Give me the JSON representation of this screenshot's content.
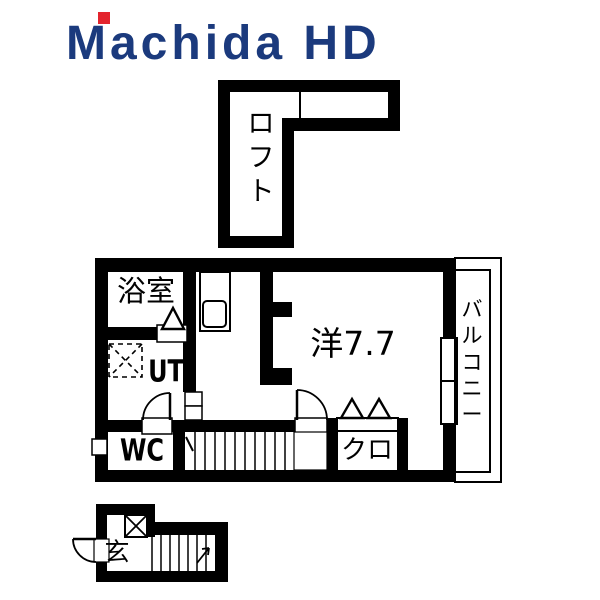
{
  "logo": {
    "text": "Machida HD",
    "color": "#1b3a7d",
    "accent_color": "#e3242d"
  },
  "colors": {
    "background": "#ffffff",
    "walls": "#000000",
    "label_text": "#000000"
  },
  "floor_plan": {
    "rooms": {
      "loft": "ロフト",
      "bathroom": "浴室",
      "utility": "UT",
      "toilet": "WC",
      "western_room": "洋7.7",
      "balcony": "バルコニー",
      "closet": "クロ",
      "entrance": "玄"
    },
    "symbols": [
      "wash-basin",
      "washing-machine-space",
      "folding-door-triangle",
      "door-swing-arc",
      "stairs",
      "stair-direction-tick",
      "pipe-space",
      "window",
      "wc-window",
      "balcony-railing",
      "x-box-shoe-cabinet"
    ]
  }
}
